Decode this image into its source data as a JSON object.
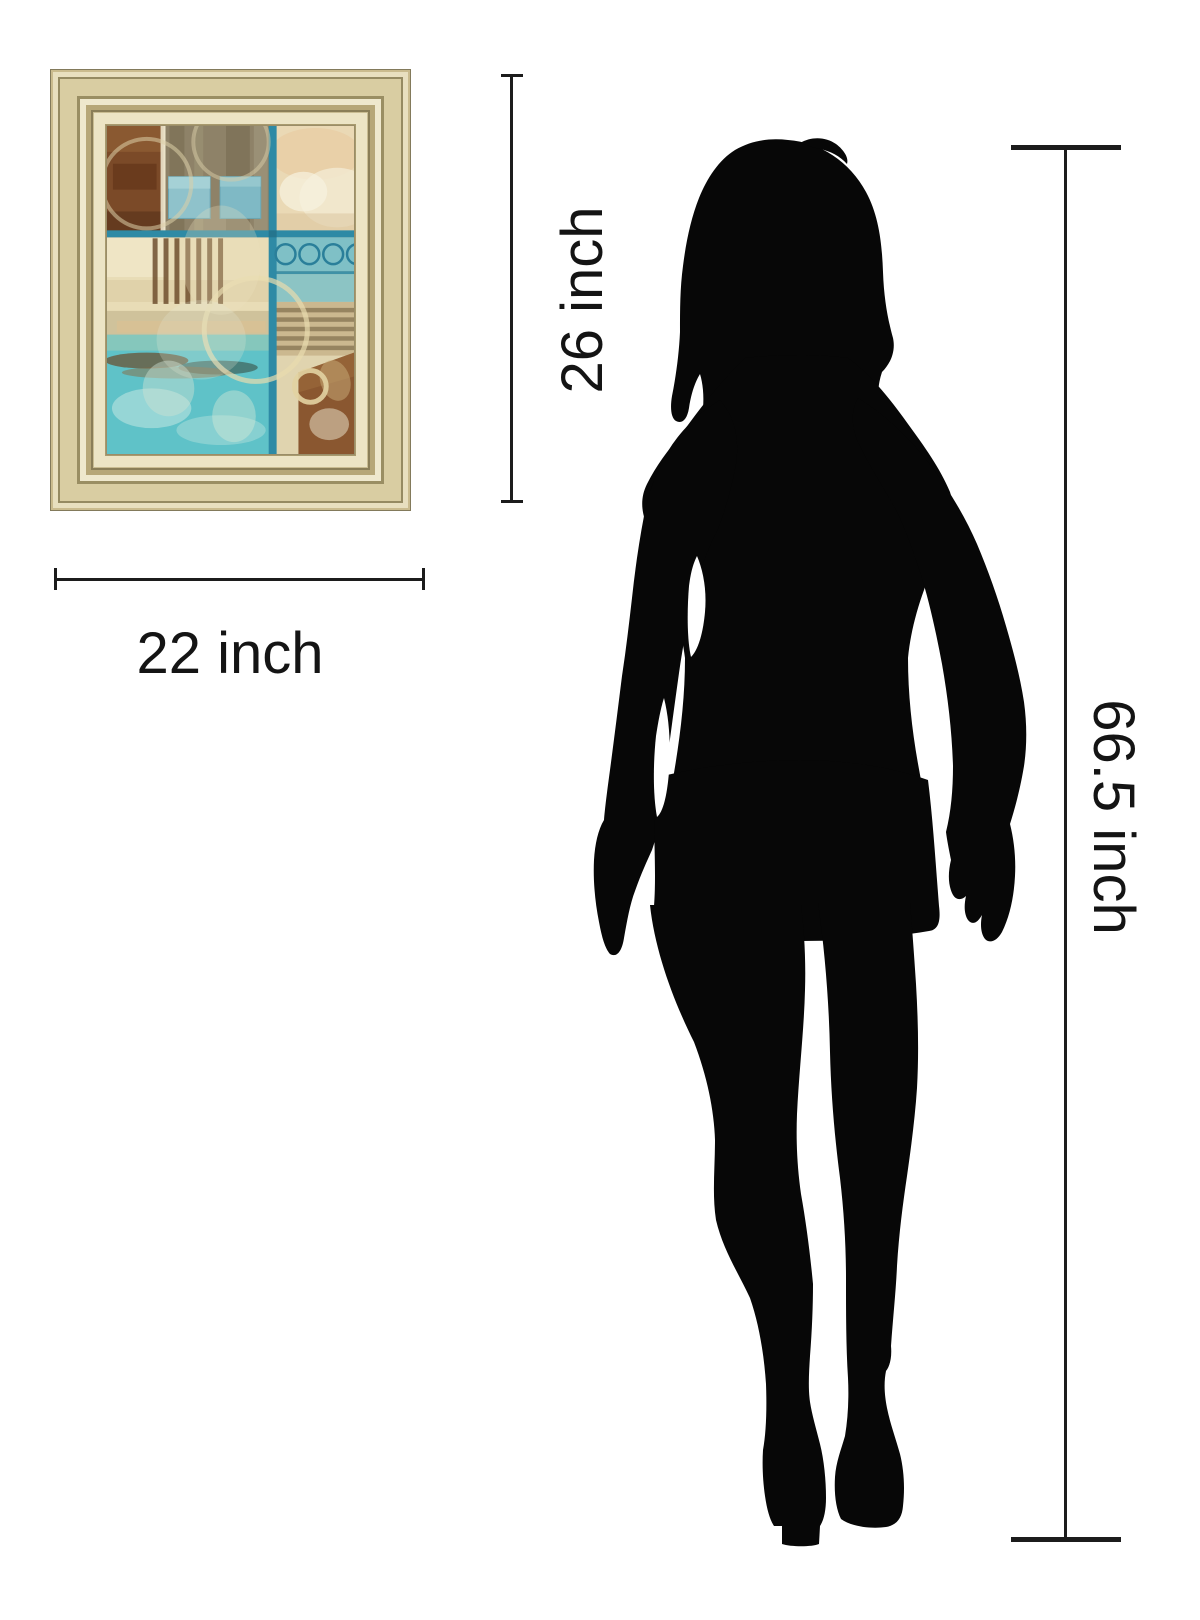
{
  "labels": {
    "art_height": "26 inch",
    "art_width": "22 inch",
    "figure_height": "66.5 inch"
  },
  "colors": {
    "dimension_line": "#1c1c1c",
    "label_text": "#141414",
    "silhouette": "#070707",
    "frame_gold": "#d9cb9f",
    "mat_cream": "#ece4c5",
    "art_teal_line": "#2e8aa5",
    "art_turquoise": "#5fc2c8",
    "art_rust": "#7b4a28",
    "art_olive": "#8e8268",
    "art_cream": "#e0d4af"
  },
  "figure": {
    "name": "standing-woman-silhouette"
  },
  "artwork": {
    "name": "framed-abstract-art-print"
  }
}
